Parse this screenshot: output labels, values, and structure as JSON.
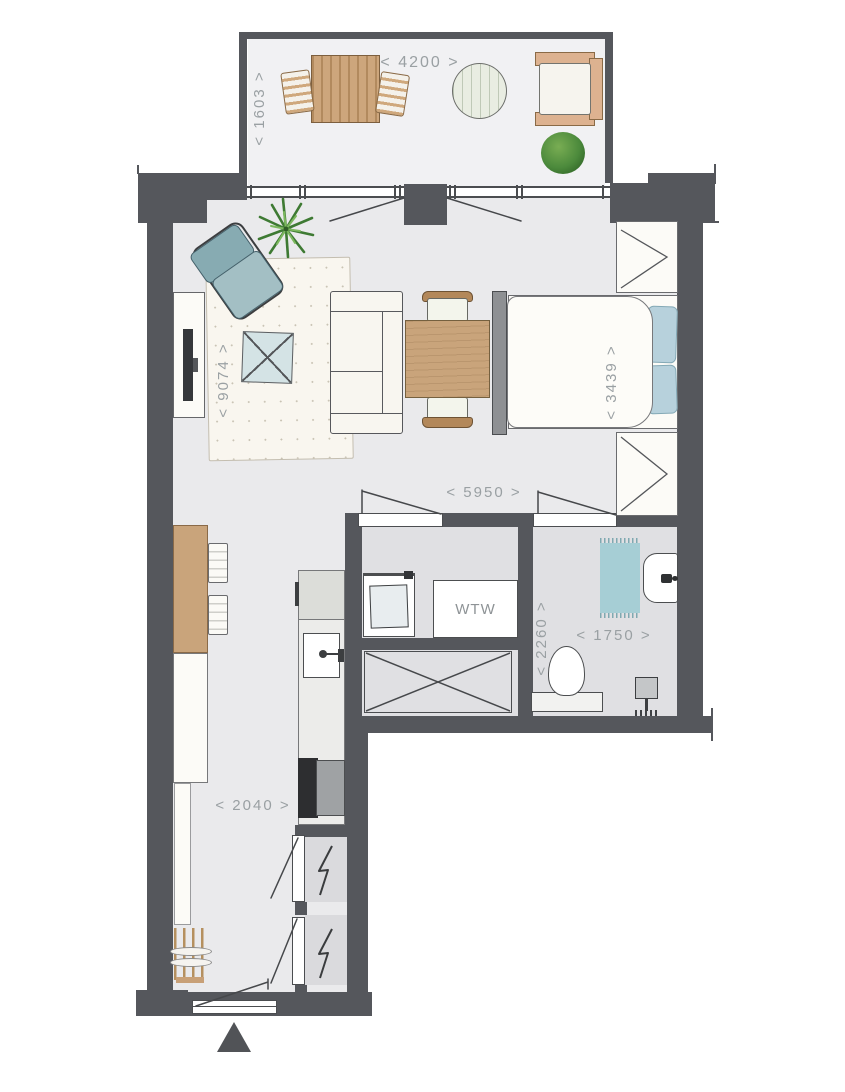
{
  "floorplan": {
    "dimensions": {
      "balcony_width": "< 4200 >",
      "balcony_depth": "< 1603 >",
      "living_length": "< 9074 >",
      "bedroom_width": "< 3439 >",
      "living_width": "< 5950 >",
      "bathroom_depth": "< 2260 >",
      "bathroom_width": "< 1750 >",
      "hallway_width": "< 2040 >"
    },
    "labels": {
      "heat_recovery_unit": "WTW"
    },
    "colors": {
      "wall": "#55575c",
      "floor_living": "#eaeaec",
      "floor_wet": "#e0e0e3",
      "floor_balcony": "#f1f1f3",
      "wood": "#c9a47b",
      "teal_chair": "#8fb2b9",
      "pillow_blue": "#b7d1dc",
      "shower_mat": "#a6ced5",
      "glass_table": "#d4e3e5",
      "plant_green": "#3e7a33",
      "dimension_text": "#9aa0a3"
    },
    "icons": [
      "entry-arrow-icon",
      "lightning-bolt-icon",
      "door-swing-icon",
      "shaft-cross-icon"
    ]
  }
}
